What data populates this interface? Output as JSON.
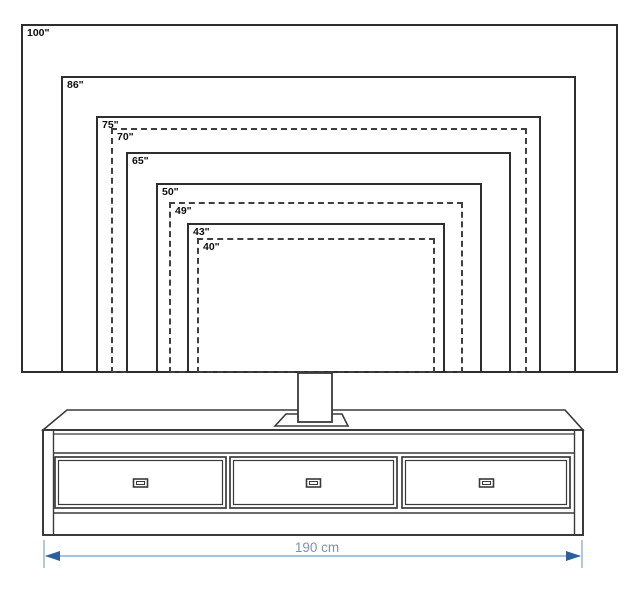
{
  "diagram": {
    "tv_sizes": [
      {
        "label": "100\"",
        "x": 21,
        "y": 24,
        "w": 597,
        "h": 349,
        "line": "solid"
      },
      {
        "label": "86\"",
        "x": 61,
        "y": 76,
        "w": 515,
        "h": 297,
        "line": "solid"
      },
      {
        "label": "75\"",
        "x": 96,
        "y": 116,
        "w": 445,
        "h": 257,
        "line": "solid"
      },
      {
        "label": "70\"",
        "x": 111,
        "y": 128,
        "w": 416,
        "h": 245,
        "line": "dashed"
      },
      {
        "label": "65\"",
        "x": 126,
        "y": 152,
        "w": 385,
        "h": 221,
        "line": "solid"
      },
      {
        "label": "50\"",
        "x": 156,
        "y": 183,
        "w": 326,
        "h": 190,
        "line": "solid"
      },
      {
        "label": "49\"",
        "x": 169,
        "y": 202,
        "w": 294,
        "h": 171,
        "line": "dashed"
      },
      {
        "label": "43\"",
        "x": 187,
        "y": 223,
        "w": 258,
        "h": 150,
        "line": "solid"
      },
      {
        "label": "40\"",
        "x": 197,
        "y": 238,
        "w": 238,
        "h": 135,
        "line": "dashed"
      }
    ],
    "stand": {
      "width_label": "190 cm",
      "drawers": 3
    },
    "colors": {
      "outline": "#3a3a3a",
      "dimension_line": "#85afd6",
      "dimension_tick": "#9db4c9",
      "dimension_arrow": "#2d5f9f",
      "dimension_text": "#7e92aa"
    }
  }
}
